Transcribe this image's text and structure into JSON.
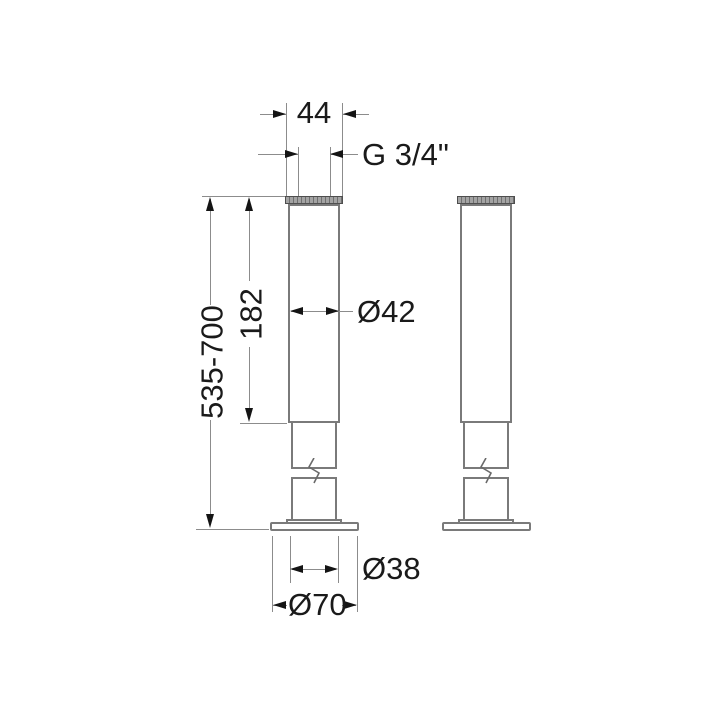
{
  "drawing": {
    "background_color": "#ffffff",
    "outline_color": "#7a7a7a",
    "dimension_line_color": "#8c8c8c",
    "text_color": "#1a1a1a",
    "labels": {
      "top_width": "44",
      "thread_size": "G 3/4\"",
      "upper_tube_length": "182",
      "overall_height_range": "535-700",
      "tube_diameter": "Ø42",
      "foot_tube_diameter": "Ø38",
      "base_plate_diameter": "Ø70"
    }
  }
}
